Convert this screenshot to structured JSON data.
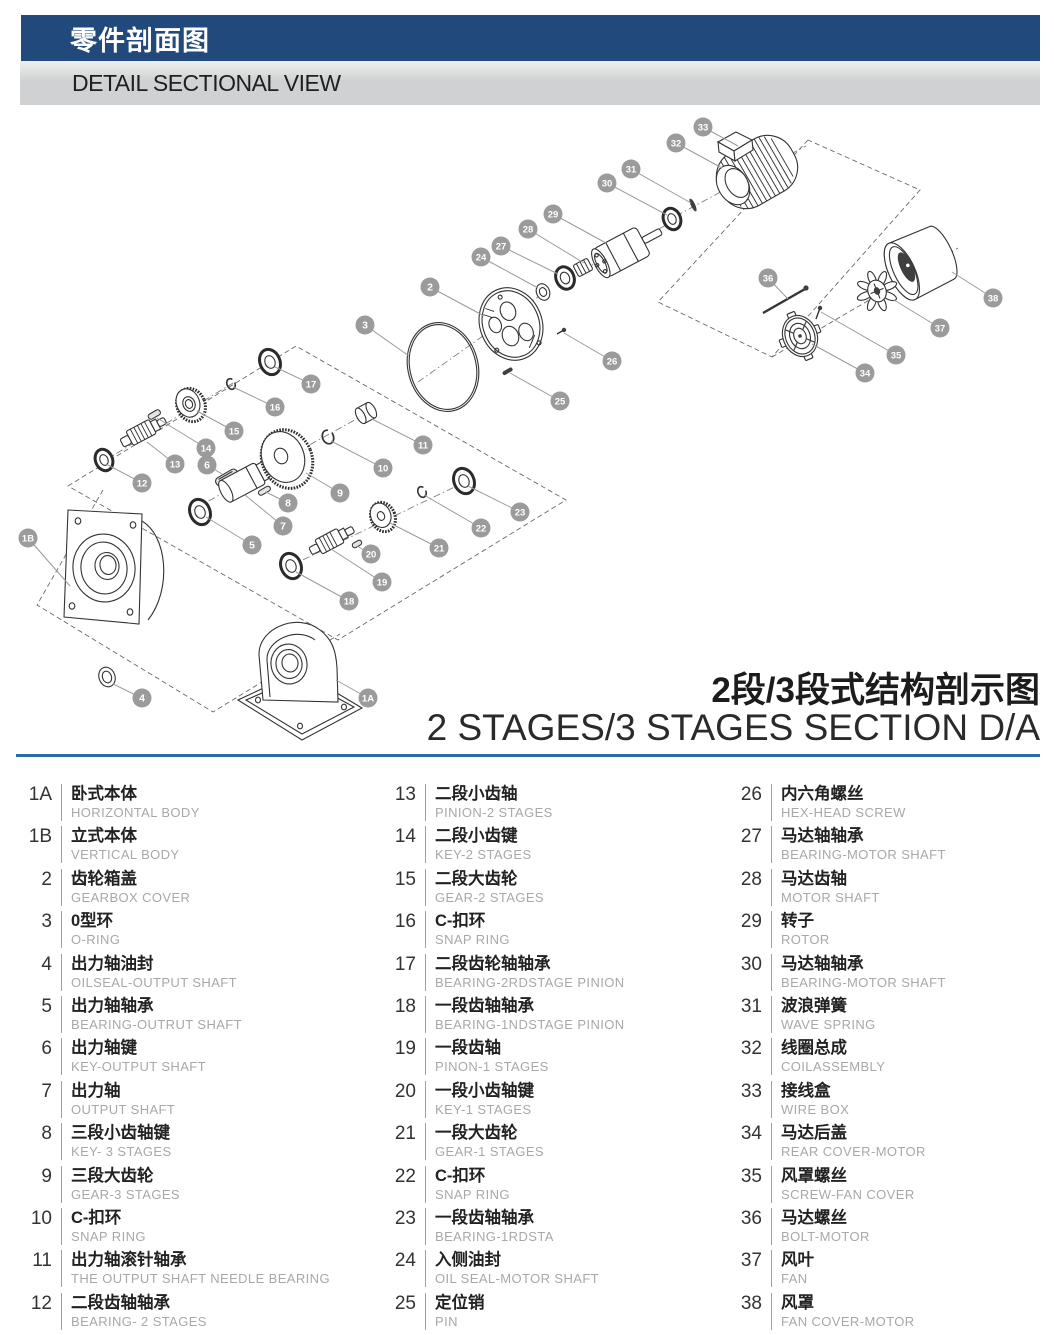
{
  "header": {
    "title_cn": "零件剖面图",
    "subtitle_en": "DETAIL SECTIONAL VIEW"
  },
  "diagram": {
    "title_cn": "2段/3段式结构剖示图",
    "title_en": "2 STAGES/3 STAGES SECTION D/A",
    "callouts": [
      {
        "label": "1A",
        "x": 368,
        "y": 698,
        "tx": 336,
        "ty": 680
      },
      {
        "label": "1B",
        "x": 28,
        "y": 538,
        "tx": 70,
        "ty": 586
      },
      {
        "label": "2",
        "x": 430,
        "y": 287,
        "tx": 484,
        "ty": 316
      },
      {
        "label": "3",
        "x": 365,
        "y": 325,
        "tx": 409,
        "ty": 356
      },
      {
        "label": "4",
        "x": 142,
        "y": 698,
        "tx": 113,
        "ty": 684
      },
      {
        "label": "5",
        "x": 252,
        "y": 545,
        "tx": 206,
        "ty": 517
      },
      {
        "label": "6",
        "x": 207,
        "y": 465,
        "tx": 222,
        "ty": 474
      },
      {
        "label": "7",
        "x": 283,
        "y": 526,
        "tx": 245,
        "ty": 495
      },
      {
        "label": "8",
        "x": 288,
        "y": 503,
        "tx": 266,
        "ty": 492
      },
      {
        "label": "9",
        "x": 340,
        "y": 493,
        "tx": 306,
        "ty": 473
      },
      {
        "label": "10",
        "x": 383,
        "y": 468,
        "tx": 331,
        "ty": 441
      },
      {
        "label": "11",
        "x": 423,
        "y": 445,
        "tx": 372,
        "ty": 419
      },
      {
        "label": "12",
        "x": 142,
        "y": 483,
        "tx": 106,
        "ty": 464
      },
      {
        "label": "13",
        "x": 175,
        "y": 464,
        "tx": 147,
        "ty": 442
      },
      {
        "label": "14",
        "x": 206,
        "y": 448,
        "tx": 157,
        "ty": 418
      },
      {
        "label": "15",
        "x": 234,
        "y": 431,
        "tx": 197,
        "ty": 411
      },
      {
        "label": "16",
        "x": 275,
        "y": 407,
        "tx": 233,
        "ty": 387
      },
      {
        "label": "17",
        "x": 311,
        "y": 384,
        "tx": 275,
        "ty": 367
      },
      {
        "label": "18",
        "x": 349,
        "y": 601,
        "tx": 296,
        "ty": 572
      },
      {
        "label": "19",
        "x": 382,
        "y": 582,
        "tx": 331,
        "ty": 549
      },
      {
        "label": "20",
        "x": 371,
        "y": 554,
        "tx": 357,
        "ty": 546
      },
      {
        "label": "21",
        "x": 439,
        "y": 548,
        "tx": 390,
        "ty": 523
      },
      {
        "label": "22",
        "x": 481,
        "y": 528,
        "tx": 424,
        "ty": 495
      },
      {
        "label": "23",
        "x": 520,
        "y": 512,
        "tx": 468,
        "ty": 486
      },
      {
        "label": "24",
        "x": 481,
        "y": 257,
        "tx": 538,
        "ty": 288
      },
      {
        "label": "25",
        "x": 560,
        "y": 401,
        "tx": 510,
        "ty": 373
      },
      {
        "label": "26",
        "x": 612,
        "y": 361,
        "tx": 564,
        "ty": 333
      },
      {
        "label": "27",
        "x": 501,
        "y": 246,
        "tx": 558,
        "ty": 274
      },
      {
        "label": "28",
        "x": 528,
        "y": 229,
        "tx": 584,
        "ty": 263
      },
      {
        "label": "29",
        "x": 553,
        "y": 214,
        "tx": 606,
        "ty": 243
      },
      {
        "label": "30",
        "x": 607,
        "y": 183,
        "tx": 667,
        "ty": 215
      },
      {
        "label": "31",
        "x": 631,
        "y": 169,
        "tx": 691,
        "ty": 203
      },
      {
        "label": "32",
        "x": 676,
        "y": 143,
        "tx": 722,
        "ty": 168
      },
      {
        "label": "33",
        "x": 703,
        "y": 127,
        "tx": 738,
        "ty": 146
      },
      {
        "label": "34",
        "x": 865,
        "y": 373,
        "tx": 812,
        "ty": 344
      },
      {
        "label": "35",
        "x": 896,
        "y": 355,
        "tx": 821,
        "ty": 312
      },
      {
        "label": "36",
        "x": 768,
        "y": 278,
        "tx": 788,
        "ty": 299
      },
      {
        "label": "37",
        "x": 940,
        "y": 328,
        "tx": 894,
        "ty": 300
      },
      {
        "label": "38",
        "x": 993,
        "y": 298,
        "tx": 952,
        "ty": 272
      }
    ]
  },
  "parts_list": {
    "columns": [
      [
        {
          "no": "1A",
          "cn": "卧式本体",
          "en": "HORIZONTAL BODY"
        },
        {
          "no": "1B",
          "cn": "立式本体",
          "en": "VERTICAL BODY"
        },
        {
          "no": "2",
          "cn": "齿轮箱盖",
          "en": "GEARBOX COVER"
        },
        {
          "no": "3",
          "cn": "0型环",
          "en": "O-RING"
        },
        {
          "no": "4",
          "cn": "出力轴油封",
          "en": "OILSEAL-OUTPUT SHAFT"
        },
        {
          "no": "5",
          "cn": "出力轴轴承",
          "en": "BEARING-OUTRUT SHAFT"
        },
        {
          "no": "6",
          "cn": "出力轴键",
          "en": "KEY-OUTPUT SHAFT"
        },
        {
          "no": "7",
          "cn": "出力轴",
          "en": "OUTPUT SHAFT"
        },
        {
          "no": "8",
          "cn": "三段小齿轴键",
          "en": "KEY- 3 STAGES"
        },
        {
          "no": "9",
          "cn": "三段大齿轮",
          "en": "GEAR-3 STAGES"
        },
        {
          "no": "10",
          "cn": "C-扣环",
          "en": "SNAP RING"
        },
        {
          "no": "11",
          "cn": "出力轴滚针轴承",
          "en": "THE OUTPUT SHAFT NEEDLE BEARING"
        },
        {
          "no": "12",
          "cn": "二段齿轴轴承",
          "en": "BEARING- 2 STAGES"
        }
      ],
      [
        {
          "no": "13",
          "cn": "二段小齿轴",
          "en": "PINION-2 STAGES"
        },
        {
          "no": "14",
          "cn": "二段小齿键",
          "en": "KEY-2 STAGES"
        },
        {
          "no": "15",
          "cn": "二段大齿轮",
          "en": "GEAR-2 STAGES"
        },
        {
          "no": "16",
          "cn": "C-扣环",
          "en": "SNAP RING"
        },
        {
          "no": "17",
          "cn": "二段齿轮轴轴承",
          "en": "BEARING-2RDSTAGE PINION"
        },
        {
          "no": "18",
          "cn": "一段齿轴轴承",
          "en": "BEARING-1NDSTAGE PINION"
        },
        {
          "no": "19",
          "cn": "一段齿轴",
          "en": "PINON-1 STAGES"
        },
        {
          "no": "20",
          "cn": "一段小齿轴键",
          "en": "KEY-1 STAGES"
        },
        {
          "no": "21",
          "cn": "一段大齿轮",
          "en": "GEAR-1 STAGES"
        },
        {
          "no": "22",
          "cn": "C-扣环",
          "en": "SNAP RING"
        },
        {
          "no": "23",
          "cn": "一段齿轴轴承",
          "en": "BEARING-1RDSTA"
        },
        {
          "no": "24",
          "cn": "入侧油封",
          "en": "OIL SEAL-MOTOR SHAFT"
        },
        {
          "no": "25",
          "cn": "定位销",
          "en": "PIN"
        }
      ],
      [
        {
          "no": "26",
          "cn": "内六角螺丝",
          "en": "HEX-HEAD SCREW"
        },
        {
          "no": "27",
          "cn": "马达轴轴承",
          "en": "BEARING-MOTOR SHAFT"
        },
        {
          "no": "28",
          "cn": "马达齿轴",
          "en": "MOTOR SHAFT"
        },
        {
          "no": "29",
          "cn": "转子",
          "en": "ROTOR"
        },
        {
          "no": "30",
          "cn": "马达轴轴承",
          "en": "BEARING-MOTOR SHAFT"
        },
        {
          "no": "31",
          "cn": "波浪弹簧",
          "en": "WAVE SPRING"
        },
        {
          "no": "32",
          "cn": "线圈总成",
          "en": "COILASSEMBLY"
        },
        {
          "no": "33",
          "cn": "接线盒",
          "en": "WIRE BOX"
        },
        {
          "no": "34",
          "cn": "马达后盖",
          "en": "REAR COVER-MOTOR"
        },
        {
          "no": "35",
          "cn": "风罩螺丝",
          "en": "SCREW-FAN COVER"
        },
        {
          "no": "36",
          "cn": "马达螺丝",
          "en": "BOLT-MOTOR"
        },
        {
          "no": "37",
          "cn": "风叶",
          "en": "FAN"
        },
        {
          "no": "38",
          "cn": "风罩",
          "en": "FAN COVER-MOTOR"
        }
      ]
    ]
  },
  "colors": {
    "header_blue": "#21497b",
    "bar_gray": "#cfd1d2",
    "accent_line": "#2e6ca8",
    "callout_gray": "#9b9b9b",
    "english_gray": "#a8a8a8",
    "line_dark": "#333333"
  }
}
